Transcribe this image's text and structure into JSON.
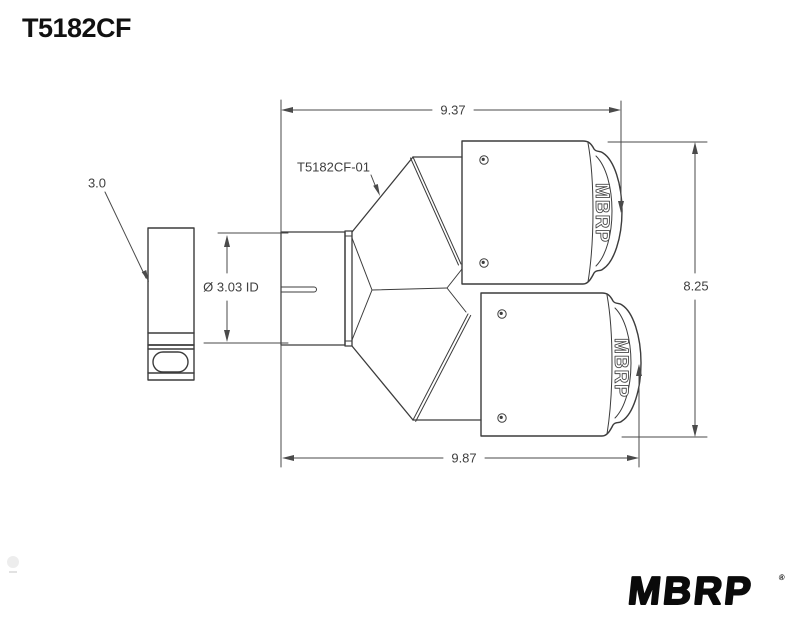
{
  "title": "T5182CF",
  "drawing": {
    "part_label": "T5182CF-01",
    "callout_od": "3.0",
    "callout_id": "Ø 3.03 ID",
    "dim_top": "9.37",
    "dim_bottom": "9.87",
    "dim_right": "8.25",
    "tip_logo": "MBRP"
  },
  "footer": {
    "brand": "MBRP",
    "reg": "®"
  },
  "colors": {
    "background": "#ffffff",
    "part_line": "#3c3c3c",
    "dim_line": "#4a4a4a",
    "text": "#3f3f3f",
    "title_text": "#111111",
    "brand_text": "#0a0a0a"
  }
}
